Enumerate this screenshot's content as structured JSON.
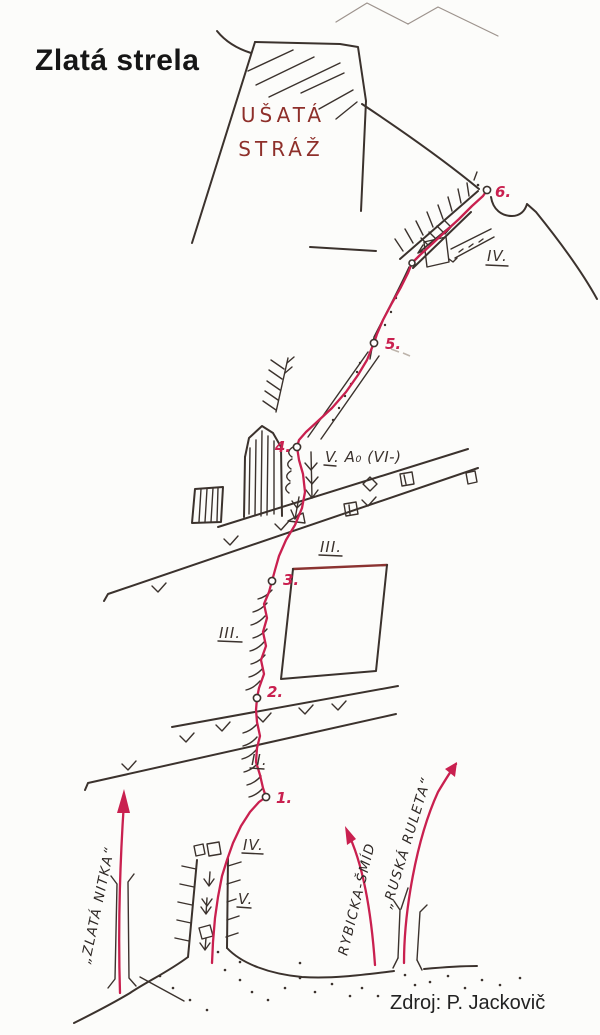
{
  "title": "Zlatá strela",
  "credit": "Zdroj: P. Jackovič",
  "summit": {
    "name_line1": "UŠATÁ",
    "name_line2": "STRÁŽ"
  },
  "main_route": {
    "name": "Zlatá strela",
    "color": "#c9204f",
    "belays": [
      {
        "label": "1."
      },
      {
        "label": "2."
      },
      {
        "label": "3."
      },
      {
        "label": "4."
      },
      {
        "label": "5."
      },
      {
        "label": "6."
      }
    ],
    "grade_labels": [
      {
        "label": "IV.",
        "section": "upper ramp below summit"
      },
      {
        "label": "V. A₀ (VI-)",
        "section": "pitch 4-5"
      },
      {
        "label": "III.",
        "section": "pitch 3-4"
      },
      {
        "label": "III.",
        "section": "pitch 2-3"
      },
      {
        "label": "II.",
        "section": "pitch 1-2"
      },
      {
        "label": "IV.",
        "section": "start chimney upper"
      },
      {
        "label": "V.",
        "section": "start chimney lower"
      }
    ]
  },
  "neighbor_routes": [
    {
      "label": "„ZLATÁ NITKA“"
    },
    {
      "label": "RYBICKA-ŠMÍD"
    },
    {
      "label": "„RUSKÁ RULETA“"
    }
  ],
  "colors": {
    "route_red": "#c9204f",
    "ink": "#3b322d",
    "summit_text": "#8e2f2a"
  }
}
